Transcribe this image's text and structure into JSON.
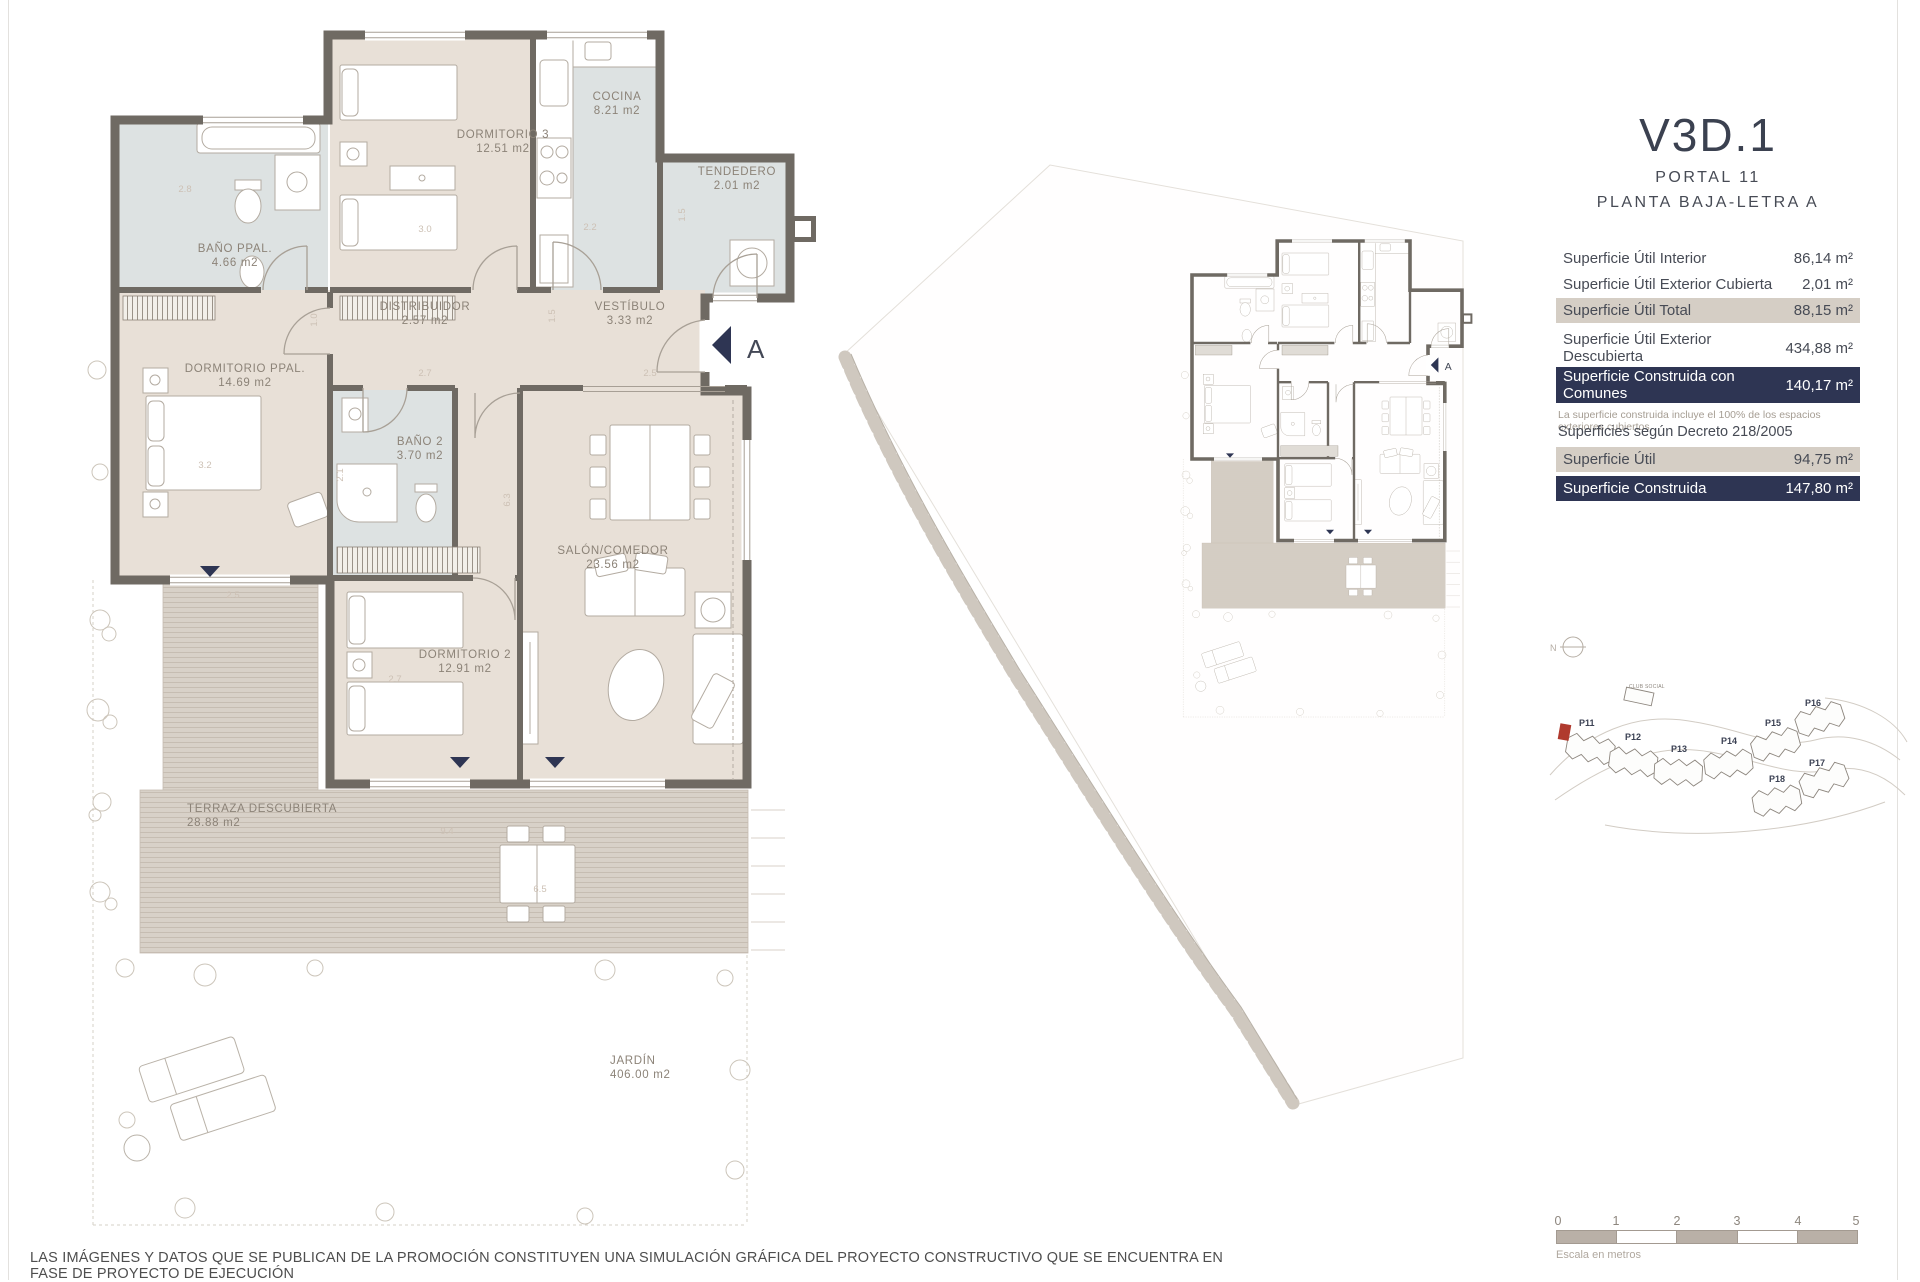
{
  "header": {
    "unit_code": "V3D.1",
    "portal": "PORTAL 11",
    "planta": "PLANTA BAJA-LETRA A"
  },
  "surface_table": {
    "rows": [
      {
        "label": "Superficie Útil Interior",
        "value": "86,14 m²",
        "style": "plain"
      },
      {
        "label": "Superficie Útil Exterior Cubierta",
        "value": "2,01 m²",
        "style": "plain"
      },
      {
        "label": "Superficie Útil Total",
        "value": "88,15 m²",
        "style": "beige"
      },
      {
        "label": "Superficie Útil Exterior Descubierta",
        "value": "434,88 m²",
        "style": "plain"
      },
      {
        "label": "Superficie Construida con Comunes",
        "value": "140,17 m²",
        "style": "navy"
      }
    ],
    "note": "La superficie construida incluye el 100% de los espacios exteriores cubiertos"
  },
  "decree": {
    "title": "Superficies según Decreto 218/2005",
    "rows": [
      {
        "label": "Superficie Útil",
        "value": "94,75 m²",
        "style": "beige"
      },
      {
        "label": "Superficie Construida",
        "value": "147,80 m²",
        "style": "navy"
      }
    ]
  },
  "floorplan": {
    "entrance": "A",
    "rooms": [
      {
        "name": "BAÑO PPAL.",
        "area": "4.66 m2"
      },
      {
        "name": "DORMITORIO 3",
        "area": "12.51 m2"
      },
      {
        "name": "COCINA",
        "area": "8.21 m2"
      },
      {
        "name": "TENDEDERO",
        "area": "2.01 m2"
      },
      {
        "name": "DISTRIBUIDOR",
        "area": "2.57 m2"
      },
      {
        "name": "VESTÍBULO",
        "area": "3.33 m2"
      },
      {
        "name": "DORMITORIO PPAL.",
        "area": "14.69 m2"
      },
      {
        "name": "BAÑO 2",
        "area": "3.70 m2"
      },
      {
        "name": "SALÓN/COMEDOR",
        "area": "23.56 m2"
      },
      {
        "name": "DORMITORIO 2",
        "area": "12.91 m2"
      },
      {
        "name": "TERRAZA DESCUBIERTA",
        "area": "28.88 m2"
      },
      {
        "name": "JARDÍN",
        "area": "406.00 m2"
      }
    ],
    "dims": [
      "2.8",
      "3.0",
      "2.2",
      "1.5",
      "1.0",
      "2.7",
      "1.5",
      "2.5",
      "2.1",
      "3.2",
      "2.7",
      "6.3",
      "2.5",
      "9.4",
      "6.5"
    ]
  },
  "site_map": {
    "club": "CLUB SOCIAL",
    "buildings": [
      "P11",
      "P12",
      "P13",
      "P14",
      "P15",
      "P16",
      "P17",
      "P18"
    ]
  },
  "compass": {
    "label": "N"
  },
  "scale_bar": {
    "ticks": [
      "0",
      "1",
      "2",
      "3",
      "4",
      "5"
    ],
    "caption": "Escala en metros"
  },
  "footer": {
    "disclaimer": "LAS IMÁGENES Y DATOS QUE SE PUBLICAN DE LA PROMOCIÓN CONSTITUYEN UNA SIMULACIÓN GRÁFICA DEL PROYECTO CONSTRUCTIVO QUE SE ENCUENTRA EN FASE DE PROYECTO DE EJECUCIÓN"
  },
  "colors": {
    "wall": "#6f6a63",
    "floor_beige": "#e8e0d7",
    "floor_wet": "#dde2e2",
    "accent_navy": "#2e3553",
    "accent_beige": "#d5cec5",
    "marker_red": "#b03a2e"
  }
}
